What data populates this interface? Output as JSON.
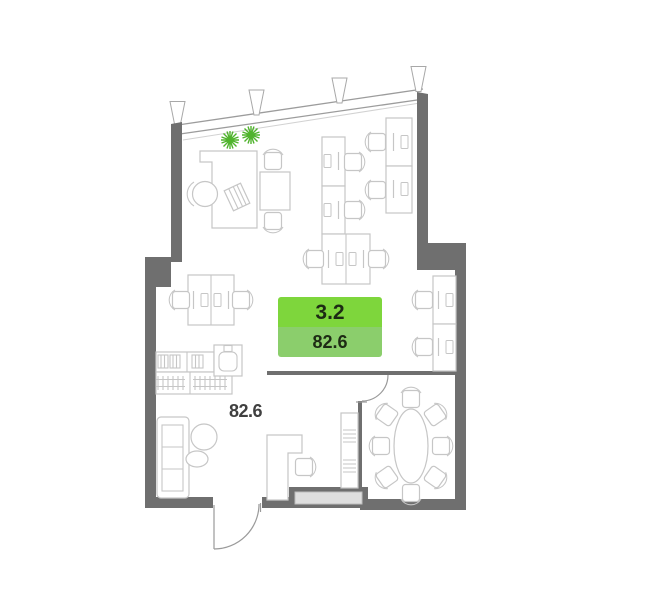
{
  "floor_plan": {
    "unit_badge": {
      "unit_number": "3.2",
      "area_sqm": "82.6"
    },
    "room_area_label": "82.6"
  },
  "colors": {
    "wall": "#6f6f6f",
    "furn": "#c6c6c6",
    "plant": "#4fb32c",
    "window_line": "#9c9c9c",
    "badge_top": "#7ed63c",
    "badge_bottom": "#8bce6c",
    "badge_text": "#1d2b14",
    "area_text": "#404040",
    "threshold_fill": "#dfdfdf"
  },
  "icons": {
    "plant-icon": "green asterisk burst",
    "window-mullion-icon": "small white trapezoid tick",
    "door-swing-icon": "quarter arc with leaf line"
  }
}
